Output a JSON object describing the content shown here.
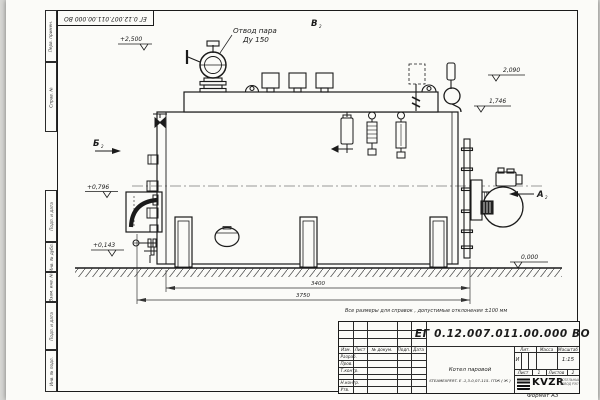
{
  "sheet": {
    "top_doc_number": "ЕГ 0.12.007.011.00.000  ВО",
    "side_labels": [
      "Перв. примен.",
      "Справ. №",
      "Подп. и дата",
      "Инв. № дубл.",
      "Взам. инв. №",
      "Подп. и дата",
      "Инв. № подл."
    ],
    "note": "Все размеры для справок , допустимые отклонения  ±100 мм",
    "format_label": "Формат А3"
  },
  "drawing": {
    "outlet_label_1": "Отвод пара",
    "outlet_label_2": "Ду 150",
    "elev_2500": "+2,500",
    "elev_2090": "2,090",
    "elev_1746": "1,746",
    "elev_0796": "+0,796",
    "elev_0143": "+0,143",
    "elev_0000": "0,000",
    "dim_length_inner": "3400",
    "dim_length_outer": "3750",
    "view_a": "А",
    "view_b": "Б",
    "view_v": "В",
    "view_sheet_ref": "2"
  },
  "title_block": {
    "doc_number": "ЕГ 0.12.007.011.00.000  ВО",
    "product_name_1": "Котел паровой",
    "product_name_2": "STEAMEXPERT- Е -1,3-0,07-115- ГПЖ ( Ж )",
    "col_izm": "Изм.",
    "col_list": "Лист",
    "col_doc": "№ докум.",
    "col_podp": "Подп.",
    "col_data": "Дата",
    "row_razrab": "Разраб.",
    "row_prov": "Пров.",
    "row_tkontr": "Т.контр.",
    "row_nkontr": "Н.контр.",
    "row_utv": "Утв.",
    "lit_label": "Лит.",
    "lit_value": "И",
    "mass_label": "Масса",
    "scale_label": "Масштаб",
    "scale_value": "1:15",
    "sheet_label": "Лист",
    "sheet_value": "1",
    "sheets_label": "Листов",
    "sheets_value": "2",
    "logo_text": "KVZR",
    "company_1": "КОТЕЛЬНЫЙ",
    "company_2": "ЗАВОД РЭП"
  }
}
